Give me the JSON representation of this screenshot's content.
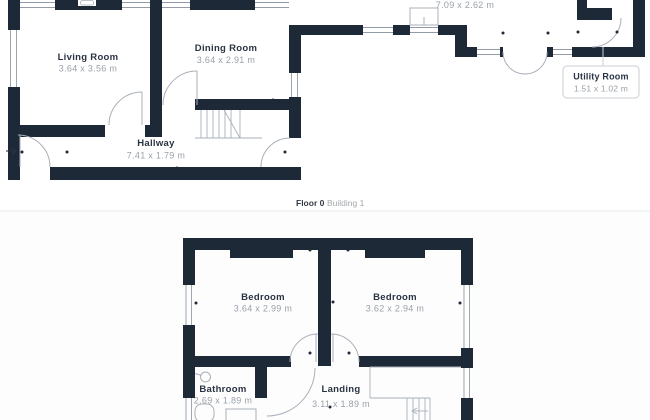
{
  "palette": {
    "wall": "#1e2938",
    "door_line": "#a9b0b8",
    "window_line": "#939ca6",
    "fixture_line": "#a9b0b8",
    "text_dark": "#2a3342",
    "text_gray": "#9aa1a9",
    "callout_border": "#c8cdd3",
    "divider": "#e9ebee"
  },
  "floor0": {
    "caption": {
      "floor": "Floor 0",
      "building": "Building 1"
    },
    "rooms": {
      "living": {
        "name": "Living Room",
        "dims": "3.64 x 3.56 m"
      },
      "dining": {
        "name": "Dining Room",
        "dims": "3.64 x 2.91 m"
      },
      "hallway": {
        "name": "Hallway",
        "dims": "7.41 x 1.79 m"
      },
      "kitchen": {
        "dims": "7.09 x 2.62 m"
      },
      "utility": {
        "name": "Utility Room",
        "dims": "1.51 x 1.02 m"
      }
    }
  },
  "floor1": {
    "rooms": {
      "bedroom_left": {
        "name": "Bedroom",
        "dims": "3.64 x 2.99 m"
      },
      "bedroom_right": {
        "name": "Bedroom",
        "dims": "3.62 x 2.94 m"
      },
      "bathroom": {
        "name": "Bathroom",
        "dims": "2.69 x 1.89 m"
      },
      "landing": {
        "name": "Landing",
        "dims": "3.11 x 1.89 m"
      }
    }
  }
}
